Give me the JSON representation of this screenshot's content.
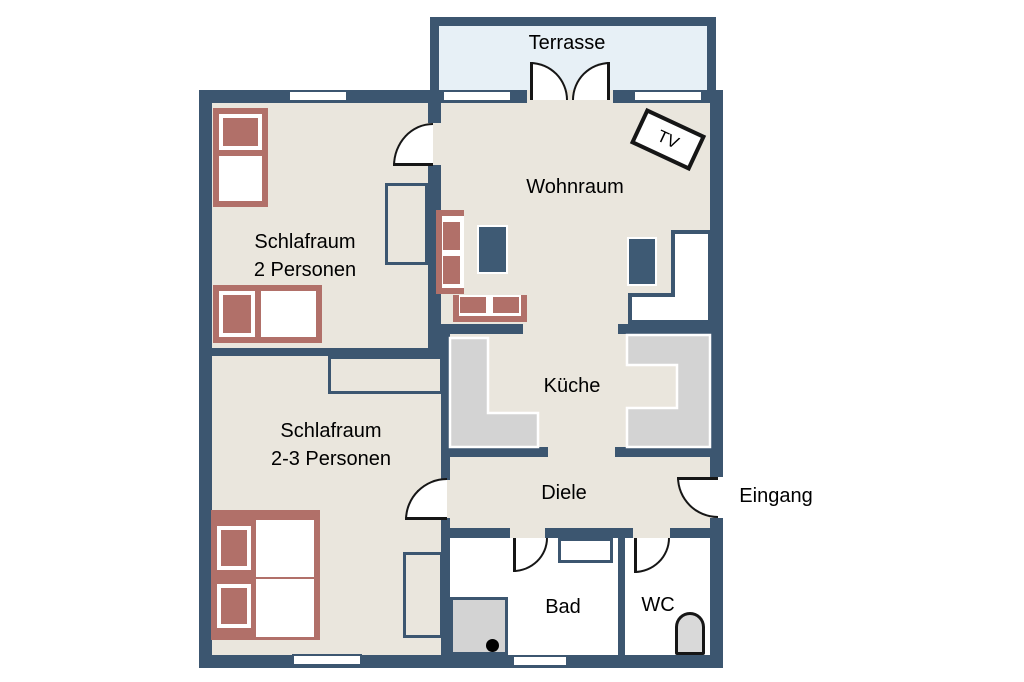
{
  "plan_title": "Apartment floor plan",
  "colors": {
    "wall": "#3c5670",
    "floor": "#eae6dd",
    "terrace": "#e7f0f6",
    "accent_red": "#b17069",
    "furniture_navy": "#3e5a74",
    "counter_gray": "#d3d3d3",
    "outline_black": "#161616"
  },
  "rooms": {
    "terrasse": {
      "label": "Terrasse"
    },
    "wohnraum": {
      "label": "Wohnraum"
    },
    "schlafraum1": {
      "line1": "Schlafraum",
      "line2": "2 Personen"
    },
    "schlafraum2": {
      "line1": "Schlafraum",
      "line2": "2-3 Personen"
    },
    "kueche": {
      "label": "Küche"
    },
    "diele": {
      "label": "Diele"
    },
    "bad": {
      "label": "Bad"
    },
    "wc": {
      "label": "WC"
    }
  },
  "annotations": {
    "eingang": "Eingang",
    "tv": "TV"
  }
}
